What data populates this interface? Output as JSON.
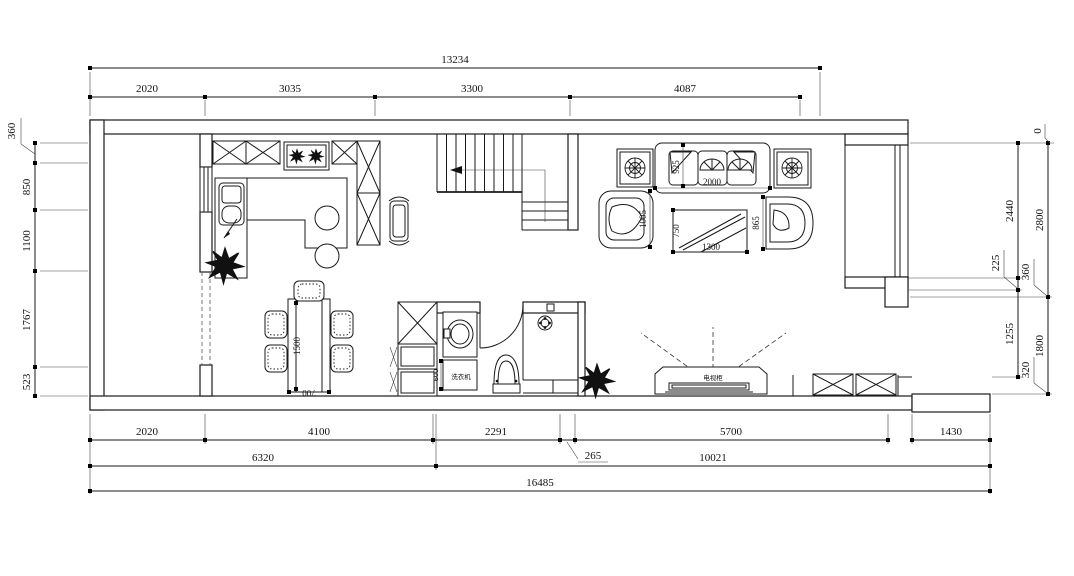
{
  "drawing": {
    "type": "residential floor plan",
    "units": "mm",
    "line_color": "#1a1a1a",
    "bg_color": "#ffffff"
  },
  "dims": {
    "top": {
      "overall": "13234",
      "segs": [
        "2020",
        "3035",
        "3300",
        "4087"
      ]
    },
    "bottom": {
      "segs": [
        "2020",
        "4100",
        "2291",
        "5700",
        "1430"
      ],
      "leader": "265",
      "row2": [
        "6320",
        "10021"
      ],
      "overall": "16485"
    },
    "left": {
      "leader": "360",
      "segs": [
        "850",
        "1100",
        "1767",
        "523"
      ]
    },
    "right_inner": {
      "top_leader": "0",
      "segs": [
        "2440",
        "1255"
      ],
      "mid_leader": "225"
    },
    "right_outer": {
      "segs": [
        "2800",
        "1800"
      ],
      "leader_upper": "360",
      "leader_lower": "320"
    }
  },
  "furniture": {
    "sofa": {
      "width": "2000",
      "depth": "925"
    },
    "armchair_left": {
      "width": "1005"
    },
    "armchair_right": {
      "width": "865"
    },
    "coffee_table": {
      "length": "1300",
      "depth": "750"
    },
    "dining_table": {
      "length": "1500",
      "width": "700"
    },
    "washing_machine": {
      "label": "洗衣机",
      "width": "600"
    },
    "tv_cabinet": {
      "label": "电视柜"
    }
  }
}
